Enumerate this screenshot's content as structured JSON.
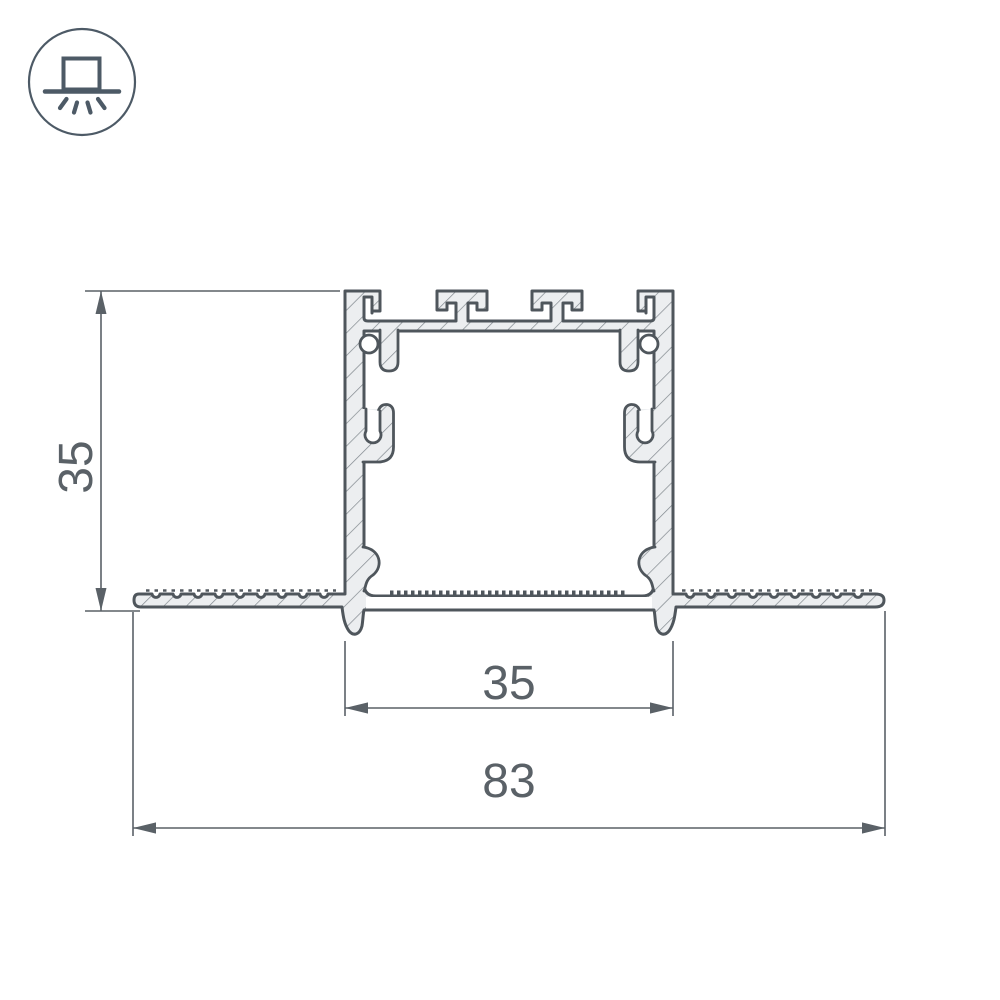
{
  "drawing": {
    "subject": "Recessed aluminium LED profile cross-section",
    "icon": {
      "name": "recessed-mount-light-icon"
    },
    "colors": {
      "outline": "#4f565c",
      "material_fill": "#eceef0",
      "hatch_line": "#80878d",
      "dimension": "#5a6167",
      "background": "#ffffff"
    },
    "dimensions": {
      "profile_height": {
        "label": "35",
        "axis": "vertical"
      },
      "recess_width": {
        "label": "35",
        "axis": "horizontal"
      },
      "overall_width": {
        "label": "83",
        "axis": "horizontal"
      }
    }
  }
}
